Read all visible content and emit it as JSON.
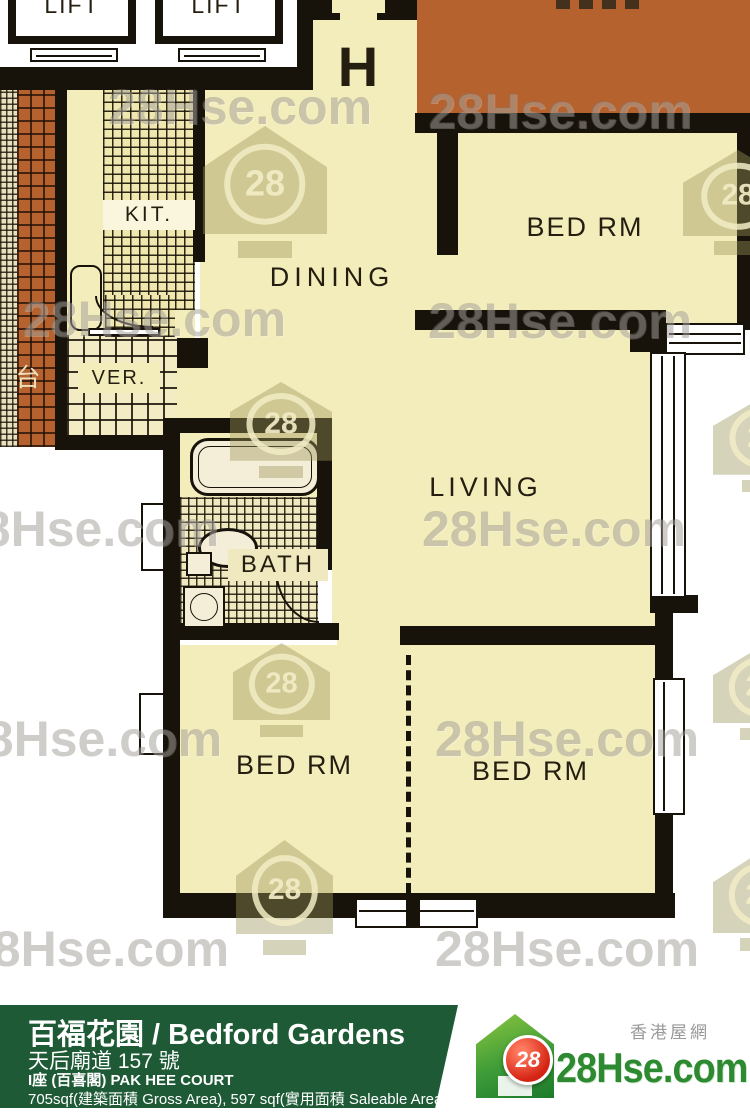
{
  "watermark": {
    "text": "28Hse.com",
    "badge": "28"
  },
  "plan": {
    "unit_label": "H",
    "rooms": {
      "lift": "LIFT",
      "kitchen": "KIT.",
      "dining": "DINING",
      "verandah": "VER.",
      "bath": "BATH",
      "living": "LIVING",
      "bedroom": "BED RM",
      "terrace": "台"
    },
    "colors": {
      "room_cream": "#f3edbb",
      "terracotta": "#b5622f",
      "wall": "#17120a"
    }
  },
  "footer": {
    "title": "百福花園 / Bedford Gardens",
    "address": "天后廟道 157 號",
    "block": "I座 (百喜閣)  PAK HEE COURT",
    "area": "705sqf(建築面積 Gross Area), 597 sqf(實用面積 Saleable Area)",
    "logo": {
      "badge": "28",
      "site": "28Hse.com",
      "tagline": "香港屋網"
    },
    "colors": {
      "bar_green": "#1d5a35",
      "logo_green": "#2e8a30",
      "logo_red": "#d42313"
    }
  }
}
